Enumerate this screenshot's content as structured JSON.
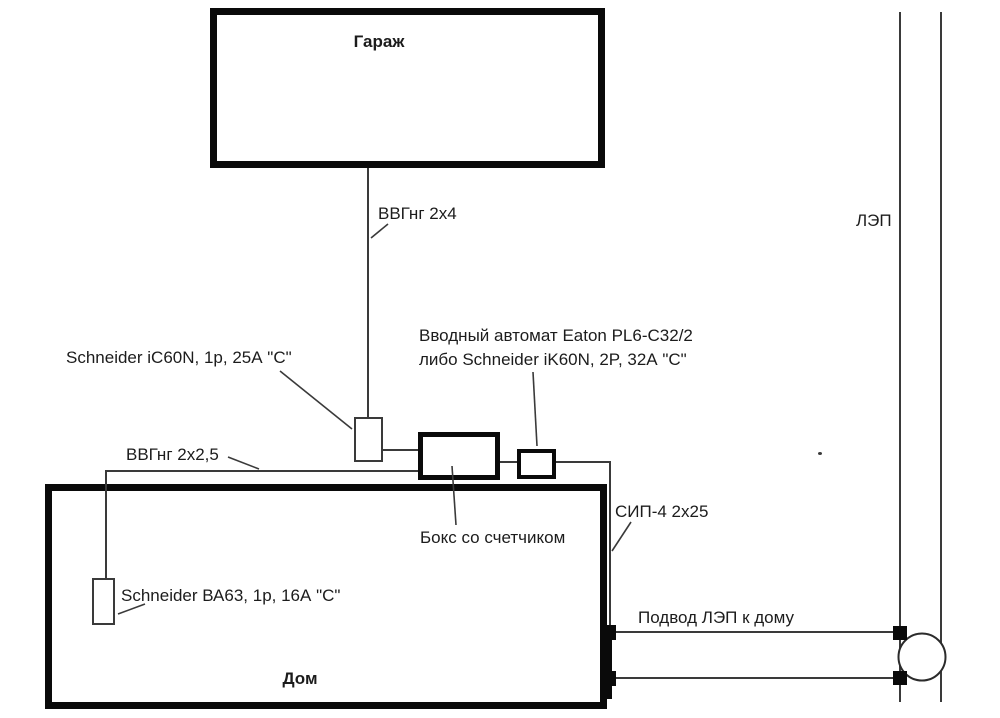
{
  "labels": {
    "garage": "Гараж",
    "house": "Дом",
    "power_line": "ЛЭП",
    "garage_cable": "ВВГнг 2х4",
    "garage_breaker": "Schneider iC60N, 1p, 25А \"С\"",
    "main_breaker_line1": "Вводный автомат Eaton PL6-C32/2",
    "main_breaker_line2": "либо Schneider iK60N, 2P, 32А \"С\"",
    "house_cable": "ВВГнг 2х2,5",
    "meter_box": "Бокс со счетчиком",
    "sip_cable": "СИП-4 2х25",
    "house_breaker": "Schneider ВА63, 1p, 16А \"С\"",
    "service_drop": "Подвод ЛЭП к дому"
  },
  "colors": {
    "background": "#ffffff",
    "thick_border": "#0a0a0a",
    "thin_line": "#3a3a3a",
    "text": "#1c1c1c"
  }
}
